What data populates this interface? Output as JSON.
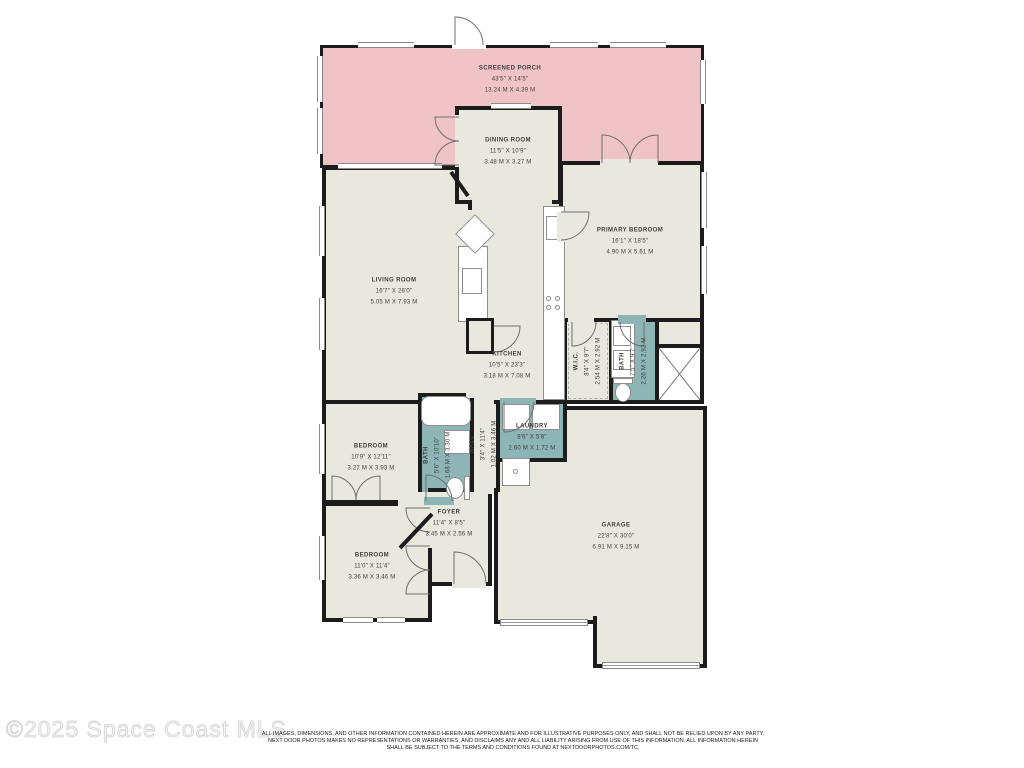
{
  "watermark": "©2025 Space Coast MLS",
  "disclaimer": {
    "line1": "ALL IMAGES, DIMENSIONS, AND OTHER INFORMATION CONTAINED HEREIN ARE APPROXIMATE AND FOR ILLUSTRATIVE PURPOSES ONLY, AND SHALL NOT BE RELIED UPON BY ANY PARTY.",
    "line2": "NEXT DOOR PHOTOS MAKES NO REPRESENTATIONS OR WARRANTIES, AND DISCLAIMS ANY AND ALL LIABILITY ARISING FROM USE OF THIS INFORMATION. ALL INFORMATION HEREIN",
    "line3": "SHALL BE SUBJECT TO THE TERMS AND CONDITIONS FOUND AT NEXTDOORPHOTOS.COM/TC."
  },
  "colors": {
    "porch": "#f0c3c7",
    "room": "#e9e8df",
    "wet_room": "#8db5b6",
    "wall": "#1c1c1c"
  },
  "rooms": {
    "screened_porch": {
      "name": "SCREENED PORCH",
      "dims_ft": "43'5\" X 14'5\"",
      "dims_m": "13.24 M X 4.39 M"
    },
    "dining_room": {
      "name": "DINING ROOM",
      "dims_ft": "11'5\" X 10'9\"",
      "dims_m": "3.48 M X 3.27 M"
    },
    "primary_bedroom": {
      "name": "PRIMARY BEDROOM",
      "dims_ft": "16'1\" X 18'5\"",
      "dims_m": "4.90 M X 5.61 M"
    },
    "living_room": {
      "name": "LIVING ROOM",
      "dims_ft": "16'7\" X 26'0\"",
      "dims_m": "5.05 M X 7.93 M"
    },
    "kitchen": {
      "name": "KITCHEN",
      "dims_ft": "10'5\" X 23'3\"",
      "dims_m": "3.18 M X 7.08 M"
    },
    "wic": {
      "name": "W.I.C.",
      "dims_ft": "8'4\" X 9'7\"",
      "dims_m": "2.54 M X 2.92 M"
    },
    "primary_bath": {
      "name": "BATH",
      "dims_ft": "7'5\" X 9'7\"",
      "dims_m": "2.26 M X 2.92 M"
    },
    "laundry": {
      "name": "LAUNDRY",
      "dims_ft": "8'6\" X 5'8\"",
      "dims_m": "2.60 M X 1.72 M"
    },
    "hall": {
      "name": "HALL",
      "dims_ft": "3'4\" X 11'4\"",
      "dims_m": "1.02 M X 3.46 M"
    },
    "bath": {
      "name": "BATH",
      "dims_ft": "5'6\" X 10'10\"",
      "dims_m": "1.68 M X 3.30 M"
    },
    "bedroom1": {
      "name": "BEDROOM",
      "dims_ft": "10'9\" X 12'11\"",
      "dims_m": "3.27 M X 3.93 M"
    },
    "foyer": {
      "name": "FOYER",
      "dims_ft": "11'4\" X 8'5\"",
      "dims_m": "3.45 M X 2.56 M"
    },
    "bedroom2": {
      "name": "BEDROOM",
      "dims_ft": "11'0\" X 11'4\"",
      "dims_m": "3.36 M X 3.46 M"
    },
    "garage": {
      "name": "GARAGE",
      "dims_ft": "22'8\" X 30'0\"",
      "dims_m": "6.91 M X 9.15 M"
    }
  }
}
